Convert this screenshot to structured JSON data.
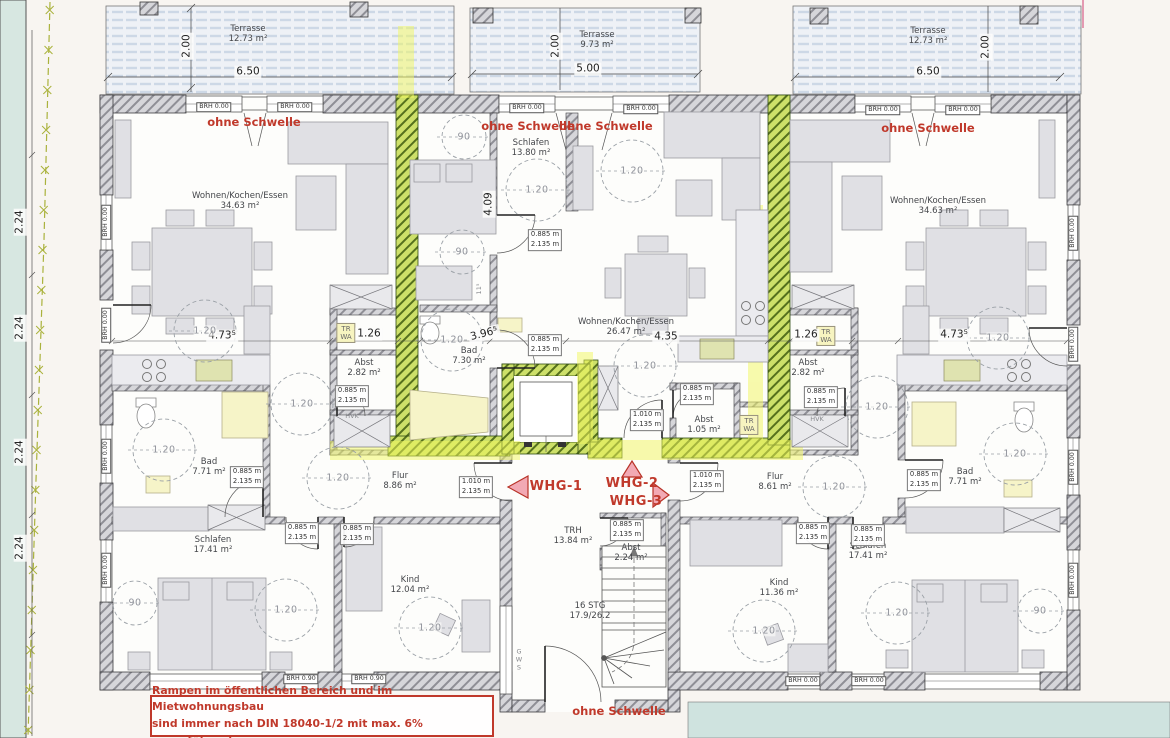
{
  "plan": {
    "type": "architectural floor plan (ground floor, 3 apartments)",
    "apartments": [
      {
        "id": "WHG-1",
        "rooms": [
          "Wohnen/Kochen/Essen 34.63 m²",
          "Bad 7.71 m²",
          "Schlafen 17.41 m²",
          "Kind 12.04 m²",
          "Flur 8.86 m²",
          "Abst 2.82 m²",
          "Terrasse 12.73 m²"
        ]
      },
      {
        "id": "WHG-2",
        "rooms": [
          "Wohnen/Kochen/Essen 26.47 m²",
          "Schlafen 13.80 m²",
          "Bad 7.30 m²",
          "Abst 1.05 m²",
          "Terrasse 9.73 m²"
        ]
      },
      {
        "id": "WHG-3",
        "rooms": [
          "Wohnen/Kochen/Essen 34.63 m²",
          "Bad 7.71 m²",
          "Schlafen 17.41 m²",
          "Kind 11.36 m²",
          "Flur 8.61 m²",
          "Abst 2.82 m²",
          "Terrasse 12.73 m²"
        ]
      }
    ],
    "stairwell": {
      "label": "TRH 13.84 m²",
      "stairs": "16 STG 17.9/26.2",
      "storage": "Abst 2.24 m²"
    }
  },
  "note": {
    "line1": "Rampen im öffentlichen Bereich und im Mietwohnungsbau",
    "line2": "sind immer nach DIN 18040-1/2 mit max. 6% auszuführen!"
  },
  "colors": {
    "red_text": "#c0392b",
    "highlight_green": "#cde069",
    "highlight_yellow": "#f2f75e",
    "wall_fill": "#d6d6da",
    "terrace_stripe": "#cdd8e6"
  },
  "annotations": [
    {
      "n": "terrasse-left-label",
      "t": "Terrasse\n12.73 m²",
      "x": 248,
      "y": 34,
      "c": "lbl"
    },
    {
      "n": "terrasse-left-width",
      "t": "6.50",
      "x": 248,
      "y": 72,
      "c": "dim"
    },
    {
      "n": "terrasse-left-depth",
      "t": "2.00",
      "x": 187,
      "y": 46,
      "c": "dim",
      "r": -90
    },
    {
      "n": "terrasse-mid-label",
      "t": "Terrasse\n9.73 m²",
      "x": 597,
      "y": 40,
      "c": "lbl"
    },
    {
      "n": "terrasse-mid-width",
      "t": "5.00",
      "x": 588,
      "y": 69,
      "c": "dim"
    },
    {
      "n": "terrasse-mid-depth",
      "t": "2.00",
      "x": 556,
      "y": 46,
      "c": "dim",
      "r": -90
    },
    {
      "n": "terrasse-right-label",
      "t": "Terrasse\n12.73 m²",
      "x": 928,
      "y": 36,
      "c": "lbl"
    },
    {
      "n": "terrasse-right-width",
      "t": "6.50",
      "x": 928,
      "y": 72,
      "c": "dim"
    },
    {
      "n": "terrasse-right-depth",
      "t": "2.00",
      "x": 986,
      "y": 47,
      "c": "dim",
      "r": -90
    },
    {
      "n": "brh-top-1",
      "t": "BRH 0.00",
      "x": 214,
      "y": 107,
      "c": "brh"
    },
    {
      "n": "brh-top-2",
      "t": "BRH 0.00",
      "x": 295,
      "y": 107,
      "c": "brh"
    },
    {
      "n": "brh-top-3",
      "t": "BRH 0.00",
      "x": 527,
      "y": 108,
      "c": "brh"
    },
    {
      "n": "brh-top-4",
      "t": "BRH 0.00",
      "x": 641,
      "y": 109,
      "c": "brh"
    },
    {
      "n": "brh-top-5",
      "t": "BRH 0.00",
      "x": 883,
      "y": 110,
      "c": "brh"
    },
    {
      "n": "brh-top-6",
      "t": "BRH 0.00",
      "x": 963,
      "y": 110,
      "c": "brh"
    },
    {
      "n": "brh-left-1",
      "t": "BRH 0.00",
      "x": 106,
      "y": 222,
      "c": "brh",
      "r": -90
    },
    {
      "n": "brh-left-2",
      "t": "BRH 0.00",
      "x": 106,
      "y": 325,
      "c": "brh",
      "r": -90
    },
    {
      "n": "brh-left-3",
      "t": "BRH 0.00",
      "x": 106,
      "y": 456,
      "c": "brh",
      "r": -90
    },
    {
      "n": "brh-left-4",
      "t": "BRH 0.00",
      "x": 106,
      "y": 570,
      "c": "brh",
      "r": -90
    },
    {
      "n": "brh-right-1",
      "t": "BRH 0.00",
      "x": 1073,
      "y": 233,
      "c": "brh",
      "r": -90
    },
    {
      "n": "brh-right-2",
      "t": "BRH 0.00",
      "x": 1073,
      "y": 344,
      "c": "brh",
      "r": -90
    },
    {
      "n": "brh-right-3",
      "t": "BRH 0.00",
      "x": 1073,
      "y": 467,
      "c": "brh",
      "r": -90
    },
    {
      "n": "brh-right-4",
      "t": "BRH 0.00",
      "x": 1073,
      "y": 580,
      "c": "brh",
      "r": -90
    },
    {
      "n": "brh-bottom-1",
      "t": "BRH 0.90",
      "x": 301,
      "y": 679,
      "c": "brh"
    },
    {
      "n": "brh-bottom-2",
      "t": "BRH 0.90",
      "x": 369,
      "y": 679,
      "c": "brh"
    },
    {
      "n": "brh-bottom-3",
      "t": "BRH 0.00",
      "x": 803,
      "y": 681,
      "c": "brh"
    },
    {
      "n": "brh-bottom-4",
      "t": "BRH 0.00",
      "x": 869,
      "y": 681,
      "c": "brh"
    },
    {
      "n": "ohne-schwelle-1",
      "t": "ohne Schwelle",
      "x": 254,
      "y": 123,
      "c": "red"
    },
    {
      "n": "ohne-schwelle-2",
      "t": "ohne Schwelle",
      "x": 528,
      "y": 127,
      "c": "red"
    },
    {
      "n": "ohne-schwelle-3",
      "t": "ohne Schwelle",
      "x": 606,
      "y": 127,
      "c": "red"
    },
    {
      "n": "ohne-schwelle-4",
      "t": "ohne Schwelle",
      "x": 928,
      "y": 129,
      "c": "red"
    },
    {
      "n": "ohne-schwelle-5",
      "t": "ohne Schwelle",
      "x": 619,
      "y": 712,
      "c": "red"
    },
    {
      "n": "whg-1-label",
      "t": "WHG-1",
      "x": 556,
      "y": 487,
      "c": "whg"
    },
    {
      "n": "whg-2-label",
      "t": "WHG-2",
      "x": 632,
      "y": 484,
      "c": "whg"
    },
    {
      "n": "whg-3-label",
      "t": "WHG-3",
      "x": 636,
      "y": 502,
      "c": "whg"
    },
    {
      "n": "room-wohnen-left",
      "t": "Wohnen/Kochen/Essen\n34.63 m²",
      "x": 240,
      "y": 201,
      "c": "lbl"
    },
    {
      "n": "room-wohnen-right",
      "t": "Wohnen/Kochen/Essen\n34.63 m²",
      "x": 938,
      "y": 206,
      "c": "lbl"
    },
    {
      "n": "room-wohnen-mid",
      "t": "Wohnen/Kochen/Essen\n26.47 m²",
      "x": 626,
      "y": 327,
      "c": "lbl"
    },
    {
      "n": "room-schlafen-mid",
      "t": "Schlafen\n13.80 m²",
      "x": 531,
      "y": 148,
      "c": "lbl"
    },
    {
      "n": "room-bad-mid",
      "t": "Bad\n7.30 m²",
      "x": 469,
      "y": 356,
      "c": "lbl"
    },
    {
      "n": "room-bad-left",
      "t": "Bad\n7.71 m²",
      "x": 209,
      "y": 467,
      "c": "lbl"
    },
    {
      "n": "room-bad-right",
      "t": "Bad\n7.71 m²",
      "x": 965,
      "y": 477,
      "c": "lbl"
    },
    {
      "n": "room-abst-left",
      "t": "Abst\n2.82 m²",
      "x": 364,
      "y": 368,
      "c": "lbl"
    },
    {
      "n": "room-abst-right",
      "t": "Abst\n2.82 m²",
      "x": 808,
      "y": 368,
      "c": "lbl"
    },
    {
      "n": "room-abst-mid",
      "t": "Abst\n1.05 m²",
      "x": 704,
      "y": 425,
      "c": "lbl"
    },
    {
      "n": "room-abst-trh",
      "t": "Abst\n2.24 m²",
      "x": 631,
      "y": 553,
      "c": "lbl"
    },
    {
      "n": "room-flur-left",
      "t": "Flur\n8.86 m²",
      "x": 400,
      "y": 481,
      "c": "lbl"
    },
    {
      "n": "room-flur-right",
      "t": "Flur\n8.61 m²",
      "x": 775,
      "y": 482,
      "c": "lbl"
    },
    {
      "n": "room-trh",
      "t": "TRH\n13.84 m²",
      "x": 573,
      "y": 536,
      "c": "lbl"
    },
    {
      "n": "stairs-label",
      "t": "16 STG\n17.9/26.2",
      "x": 590,
      "y": 611,
      "c": "lbl"
    },
    {
      "n": "room-schlafen-left",
      "t": "Schlafen\n17.41 m²",
      "x": 213,
      "y": 545,
      "c": "lbl"
    },
    {
      "n": "room-schlafen-right",
      "t": "Schlafen\n17.41 m²",
      "x": 868,
      "y": 551,
      "c": "lbl"
    },
    {
      "n": "room-kind-left",
      "t": "Kind\n12.04 m²",
      "x": 410,
      "y": 585,
      "c": "lbl"
    },
    {
      "n": "room-kind-right",
      "t": "Kind\n11.36 m²",
      "x": 779,
      "y": 588,
      "c": "lbl"
    },
    {
      "n": "trwa-left",
      "t": "TR\nWA",
      "x": 346,
      "y": 333,
      "c": "trwa"
    },
    {
      "n": "trwa-right",
      "t": "TR\nWA",
      "x": 826,
      "y": 336,
      "c": "trwa"
    },
    {
      "n": "trwa-mid",
      "t": "TR\nWA",
      "x": 749,
      "y": 425,
      "c": "trwa"
    },
    {
      "n": "hvk-left",
      "t": "HVK",
      "x": 352,
      "y": 417,
      "c": "tiny"
    },
    {
      "n": "hvk-right",
      "t": "HVK",
      "x": 817,
      "y": 420,
      "c": "tiny"
    },
    {
      "n": "gws-label",
      "t": "G\nW\nS",
      "x": 519,
      "y": 660,
      "c": "tiny"
    },
    {
      "n": "dim-473-left",
      "t": "4.73⁵",
      "x": 222,
      "y": 336,
      "c": "dim"
    },
    {
      "n": "dim-473-right",
      "t": "4.73⁵",
      "x": 954,
      "y": 335,
      "c": "dim"
    },
    {
      "n": "dim-126-left",
      "t": "1.26",
      "x": 369,
      "y": 334,
      "c": "dim"
    },
    {
      "n": "dim-126-right",
      "t": "1.26",
      "x": 806,
      "y": 335,
      "c": "dim"
    },
    {
      "n": "dim-435-mid",
      "t": "4.35",
      "x": 666,
      "y": 337,
      "c": "dim"
    },
    {
      "n": "dim-396-mid",
      "t": "3.96⁵",
      "x": 484,
      "y": 334,
      "c": "dim",
      "r": -14
    },
    {
      "n": "dim-409-mid",
      "t": "4.09",
      "x": 489,
      "y": 204,
      "c": "dim",
      "r": -90
    },
    {
      "n": "dim-115-mid",
      "t": "11⁵",
      "x": 480,
      "y": 289,
      "c": "tiny",
      "r": -90
    },
    {
      "n": "dim-224-1",
      "t": "2.24",
      "x": 20,
      "y": 222,
      "c": "dim",
      "r": -90
    },
    {
      "n": "dim-224-2",
      "t": "2.24",
      "x": 20,
      "y": 328,
      "c": "dim",
      "r": -90
    },
    {
      "n": "dim-224-3",
      "t": "2.24",
      "x": 20,
      "y": 452,
      "c": "dim",
      "r": -90
    },
    {
      "n": "dim-224-4",
      "t": "2.24",
      "x": 20,
      "y": 548,
      "c": "dim",
      "r": -90
    },
    {
      "n": "door-schlafen-mid",
      "t": "0.885 m\n2.135 m",
      "x": 545,
      "y": 240,
      "c": "door"
    },
    {
      "n": "door-bad-mid",
      "t": "0.885 m\n2.135 m",
      "x": 545,
      "y": 345,
      "c": "door"
    },
    {
      "n": "door-abst-left",
      "t": "0.885 m\n2.135 m",
      "x": 352,
      "y": 396,
      "c": "door"
    },
    {
      "n": "door-bad-left",
      "t": "0.885 m\n2.135 m",
      "x": 247,
      "y": 477,
      "c": "door"
    },
    {
      "n": "door-schlafen-left",
      "t": "0.885 m\n2.135 m",
      "x": 302,
      "y": 533,
      "c": "door"
    },
    {
      "n": "door-kind-left",
      "t": "0.885 m\n2.135 m",
      "x": 357,
      "y": 534,
      "c": "door"
    },
    {
      "n": "door-abst-trh",
      "t": "0.885 m\n2.135 m",
      "x": 627,
      "y": 530,
      "c": "door"
    },
    {
      "n": "door-abst-right",
      "t": "0.885 m\n2.135 m",
      "x": 821,
      "y": 397,
      "c": "door"
    },
    {
      "n": "door-bad-right",
      "t": "0.885 m\n2.135 m",
      "x": 924,
      "y": 480,
      "c": "door"
    },
    {
      "n": "door-kind-right",
      "t": "0.885 m\n2.135 m",
      "x": 813,
      "y": 533,
      "c": "door"
    },
    {
      "n": "door-schlafen-right",
      "t": "0.885 m\n2.135 m",
      "x": 868,
      "y": 535,
      "c": "door"
    },
    {
      "n": "door-abst-mid",
      "t": "0.885 m\n2.135 m",
      "x": 697,
      "y": 394,
      "c": "door"
    },
    {
      "n": "door-whg1",
      "t": "1.010 m\n2.135 m",
      "x": 476,
      "y": 487,
      "c": "door"
    },
    {
      "n": "door-whg2",
      "t": "1.010 m\n2.135 m",
      "x": 647,
      "y": 420,
      "c": "door"
    },
    {
      "n": "door-whg3",
      "t": "1.010 m\n2.135 m",
      "x": 707,
      "y": 481,
      "c": "door"
    },
    {
      "n": "circle-120-left-living",
      "t": "1.20",
      "x": 205,
      "y": 331,
      "c": "circ"
    },
    {
      "n": "circle-120-left-bad",
      "t": "1.20",
      "x": 164,
      "y": 450,
      "c": "circ"
    },
    {
      "n": "circle-120-left-hall",
      "t": "1.20",
      "x": 302,
      "y": 404,
      "c": "circ"
    },
    {
      "n": "circle-120-left-flur",
      "t": "1.20",
      "x": 338,
      "y": 478,
      "c": "circ"
    },
    {
      "n": "circle-120-left-schlafen",
      "t": "1.20",
      "x": 286,
      "y": 610,
      "c": "circ"
    },
    {
      "n": "circle-120-left-kind",
      "t": "1.20",
      "x": 430,
      "y": 628,
      "c": "circ"
    },
    {
      "n": "circle-120-mid-schlafen",
      "t": "1.20",
      "x": 537,
      "y": 190,
      "c": "circ"
    },
    {
      "n": "circle-120-mid-living1",
      "t": "1.20",
      "x": 632,
      "y": 171,
      "c": "circ"
    },
    {
      "n": "circle-120-mid-living2",
      "t": "1.20",
      "x": 645,
      "y": 366,
      "c": "circ"
    },
    {
      "n": "circle-120-mid-bad",
      "t": "1.20",
      "x": 452,
      "y": 340,
      "c": "circ"
    },
    {
      "n": "circle-120-right-hall",
      "t": "1.20",
      "x": 877,
      "y": 407,
      "c": "circ"
    },
    {
      "n": "circle-120-right-flur",
      "t": "1.20",
      "x": 834,
      "y": 487,
      "c": "circ"
    },
    {
      "n": "circle-120-right-bad",
      "t": "1.20",
      "x": 1015,
      "y": 454,
      "c": "circ"
    },
    {
      "n": "circle-120-right-living",
      "t": "1.20",
      "x": 998,
      "y": 338,
      "c": "circ"
    },
    {
      "n": "circle-120-right-schlafen",
      "t": "1.20",
      "x": 897,
      "y": 613,
      "c": "circ"
    },
    {
      "n": "circle-120-right-kind",
      "t": "1.20",
      "x": 764,
      "y": 631,
      "c": "circ"
    },
    {
      "n": "circle-90-mid-1",
      "t": "90",
      "x": 464,
      "y": 137,
      "c": "circ"
    },
    {
      "n": "circle-90-mid-2",
      "t": "90",
      "x": 462,
      "y": 252,
      "c": "circ"
    },
    {
      "n": "circle-90-left",
      "t": "90",
      "x": 135,
      "y": 603,
      "c": "circ"
    },
    {
      "n": "circle-90-right",
      "t": "90",
      "x": 1040,
      "y": 611,
      "c": "circ"
    }
  ]
}
